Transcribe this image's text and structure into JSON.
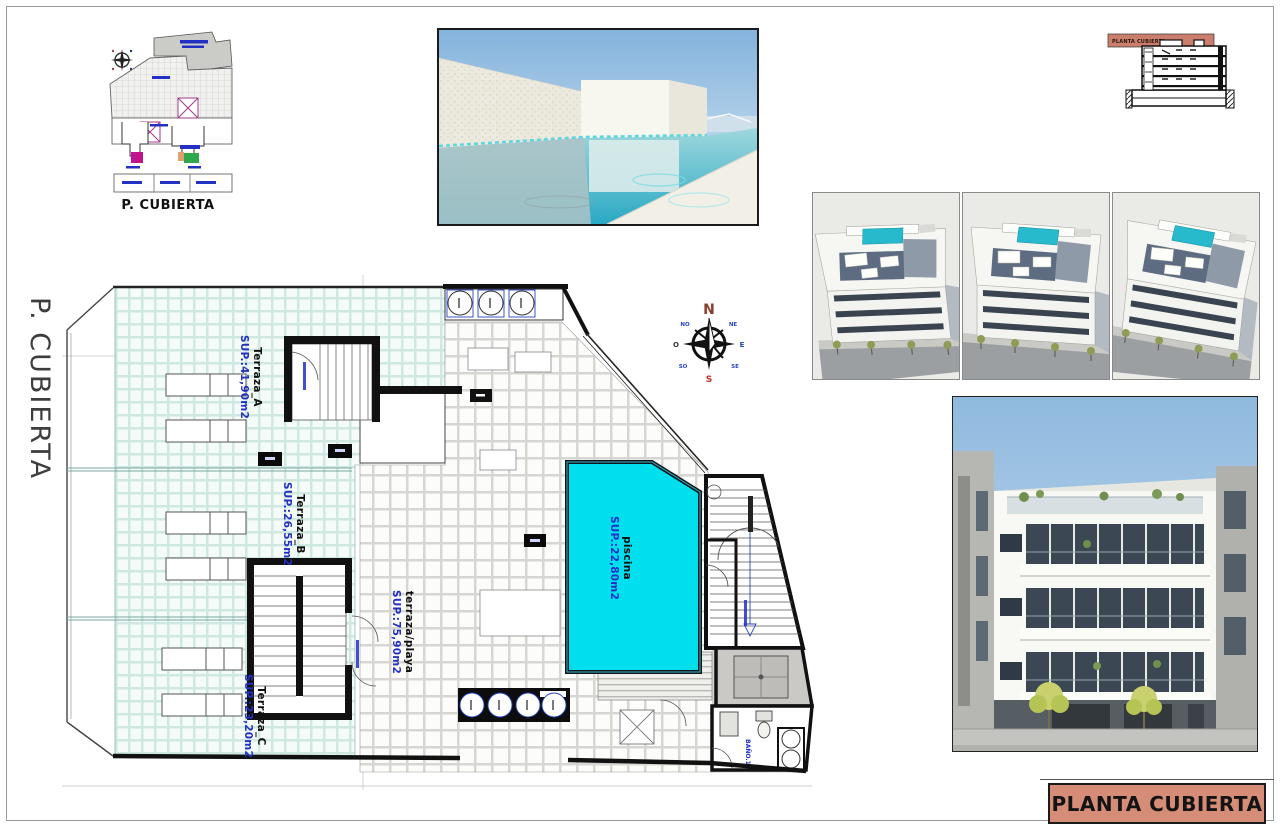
{
  "margin_label": "P. CUBIERTA",
  "key_plan": {
    "caption": "P. CUBIERTA"
  },
  "section_diagram": {
    "band_label": "PLANTA CUBIERTA",
    "band_color": "#cb7e6c"
  },
  "compass": {
    "n": "N",
    "ne": "NE",
    "e": "E",
    "se": "SE",
    "s": "S",
    "so": "SO",
    "o": "O",
    "no": "NO"
  },
  "floor_plan": {
    "terraza_a": {
      "name": "Terraza_A",
      "area": "SUP.:41,90m2"
    },
    "terraza_b": {
      "name": "Terraza_B",
      "area": "SUP.:26,55m2"
    },
    "terraza_c": {
      "name": "Terraza_C",
      "area": "SUP.:23,20m2"
    },
    "terraza_playa": {
      "name": "terraza/playa",
      "area": "SUP.:75,90m2"
    },
    "piscina": {
      "name": "piscina",
      "area": "SUP.:22,80m2"
    },
    "bano": {
      "name": "BAÑO.1"
    },
    "colors": {
      "pool": "#00dfee",
      "label_blue": "#2330c4",
      "tile_mint": "#cfe9e2"
    }
  },
  "title_block": {
    "label": "PLANTA CUBIERTA",
    "bg": "#d68d77"
  }
}
